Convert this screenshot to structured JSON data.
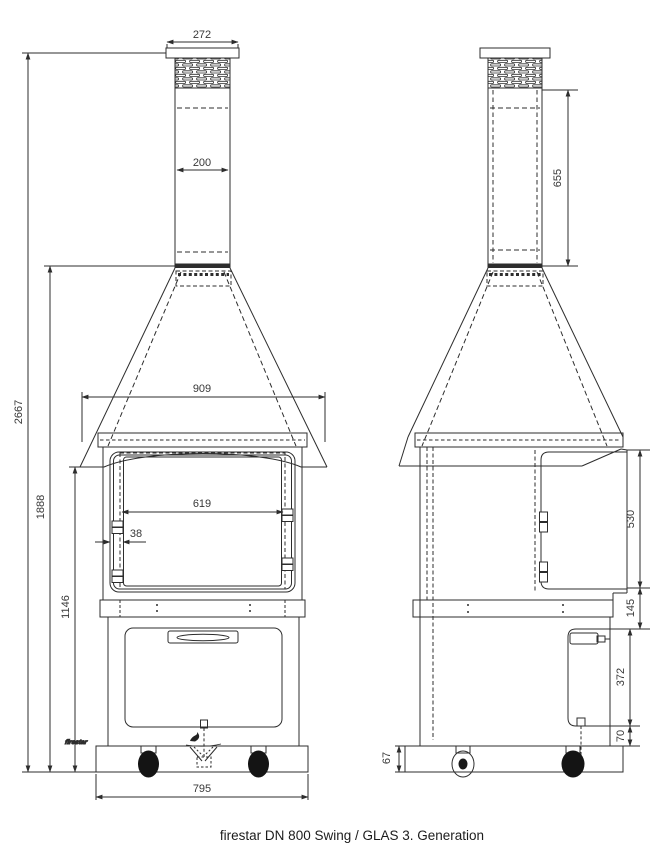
{
  "title": "firestar DN 800 Swing / GLAS 3. Generation",
  "logo_text": "firestar",
  "dimensions_mm": {
    "chimney_cap_width": "272",
    "flue_width": "200",
    "hood_width": "909",
    "glass_door_width": "619",
    "door_frame_offset": "38",
    "base_width": "795",
    "overall_height": "2667",
    "height_to_hood_top": "1888",
    "height_to_hood_bottom": "1146",
    "flue_visible_length": "655",
    "firebox_door_height": "530",
    "shelf_band_height": "145",
    "cabinet_door_height": "372",
    "cabinet_door_bottom_gap": "70",
    "base_frame_height": "67"
  },
  "colors": {
    "line": "#2d2d2d",
    "dim_text": "#383838",
    "background": "#ffffff"
  }
}
